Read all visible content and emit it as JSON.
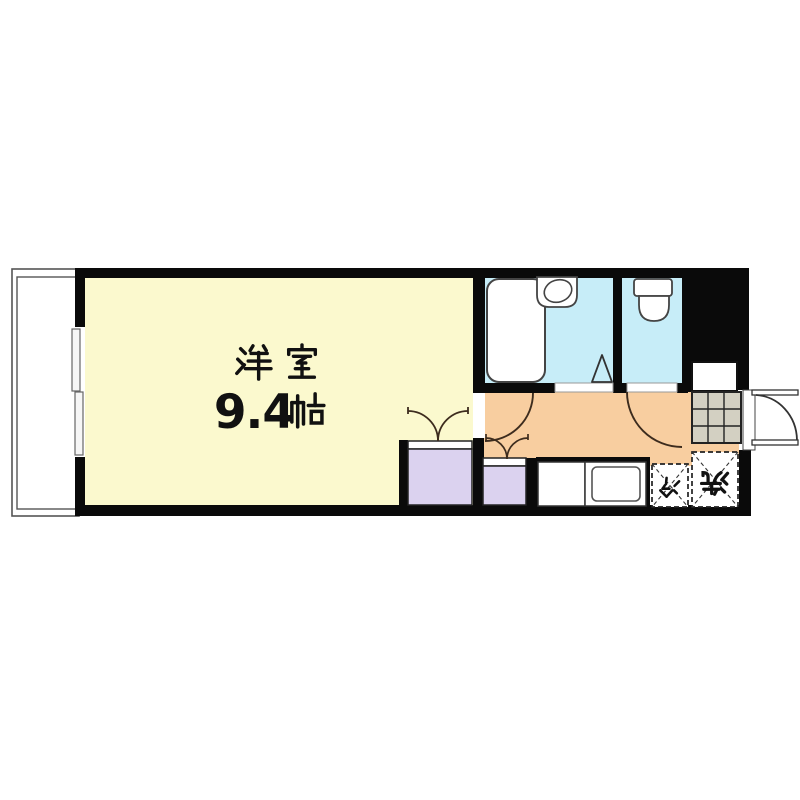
{
  "room": {
    "name": "洋室",
    "size_value": "9.4",
    "size_unit": "帖",
    "full_label": "洋室 9.4帖"
  },
  "labels": {
    "refrigerator": "冷",
    "washer": "洗"
  },
  "colors": {
    "room_floor": "#fbf9ce",
    "wet_area_floor": "#c7edf8",
    "hallway_floor": "#f8cea0",
    "closet_fill": "#dbd2ef",
    "shoe_grid_fill": "#d3d0c2",
    "wall": "#0a0a0a",
    "outline": "#333333"
  },
  "icons": {
    "balcony": "balcony",
    "bathtub": "bathtub",
    "washbasin": "washbasin",
    "toilet": "toilet",
    "kitchen_sink": "kitchen-sink",
    "shoe_cabinet": "shoe-cabinet",
    "entrance_door": "entrance-door"
  }
}
